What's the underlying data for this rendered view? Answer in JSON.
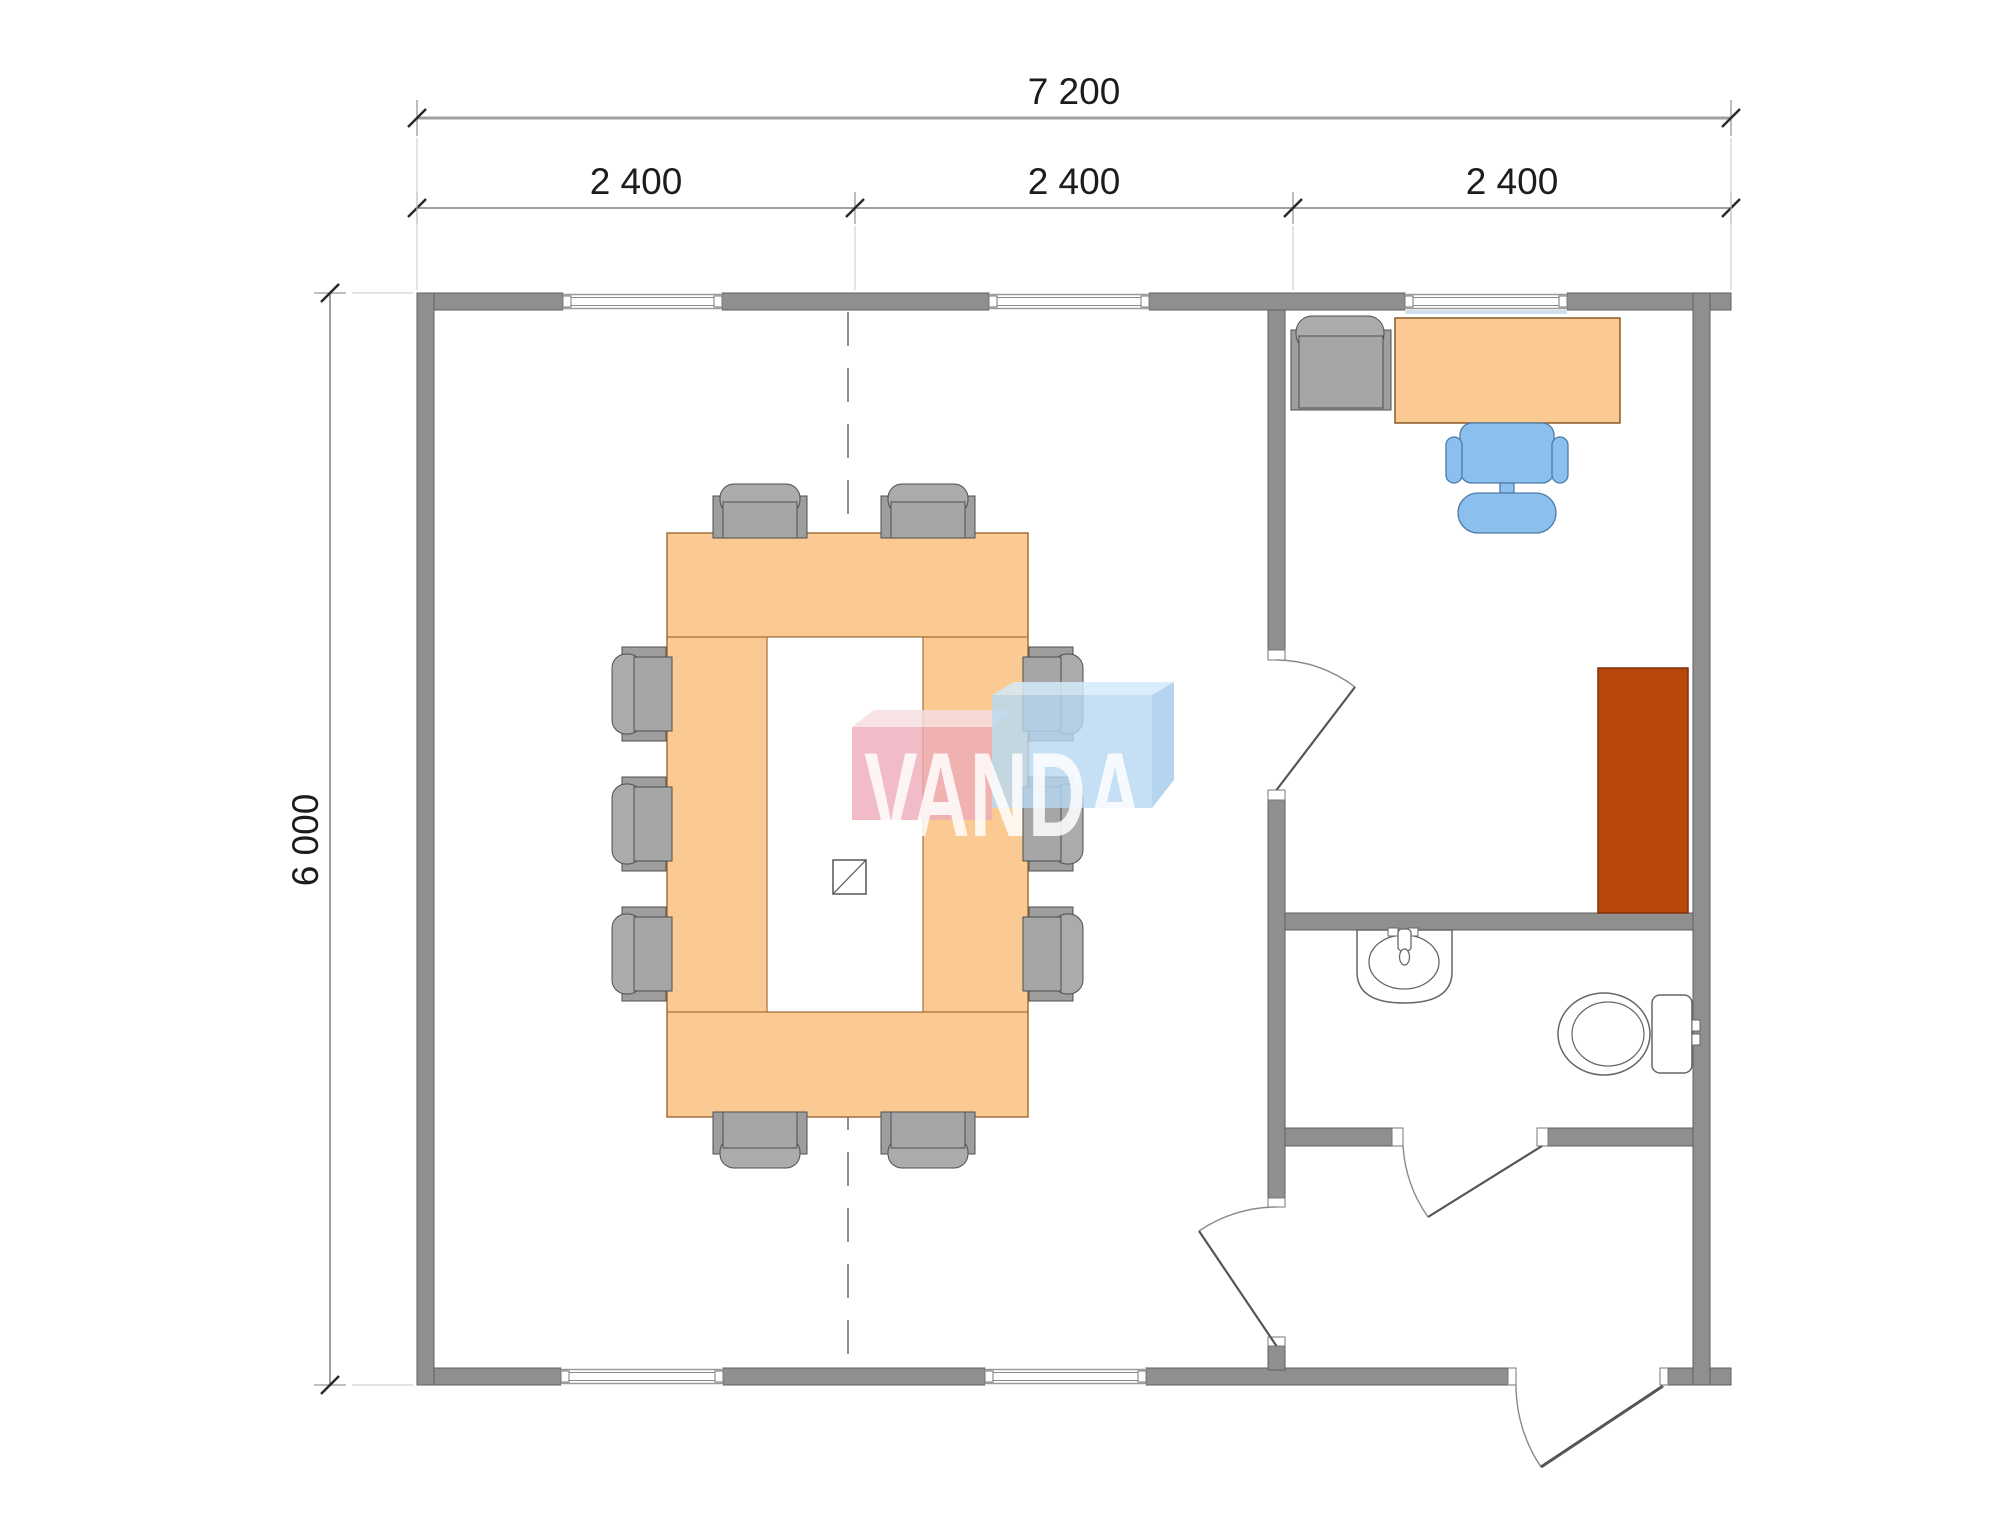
{
  "drawing": {
    "type": "floor-plan",
    "dimensions": {
      "overall_width": "7 200",
      "width_segments": [
        "2 400",
        "2 400",
        "2 400"
      ],
      "overall_height": "6 000"
    },
    "watermark": {
      "text": "VANDA"
    },
    "colors": {
      "wall": "#8a8a8a",
      "table": "#fbca92",
      "table_border": "#a2703b",
      "cabinet": "#b8470b",
      "chair_gray": "#a8a8a8",
      "chair_blue": "#8bc0ee",
      "logo_pink": "#eeaab9",
      "logo_blue": "#b7d8f2",
      "dimension_line": "#a0a0a0"
    },
    "furniture_icons": [
      "conference-ring-table",
      "conference-chair",
      "office-desk",
      "office-swivel-chair",
      "guest-armchair",
      "tall-cabinet",
      "sink",
      "toilet",
      "grid-node-symbol"
    ]
  }
}
